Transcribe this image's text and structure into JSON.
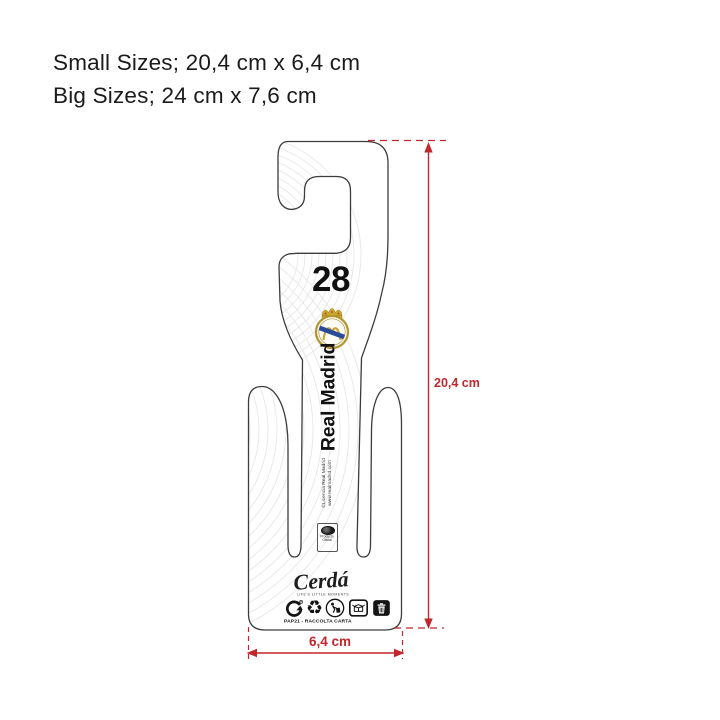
{
  "header": {
    "line1": "Small Sizes; 20,4 cm x 6,4 cm",
    "line2": "Big Sizes; 24 cm x 7,6 cm"
  },
  "hanger": {
    "player_number": "28",
    "team_name": "Real Madrid",
    "license_line1": "©Licencia Real Madrid",
    "license_line2": "www.realmadrid.com",
    "stamp": {
      "line1": "Producto",
      "line2": "Oficial"
    },
    "brand_name": "Cerdá",
    "brand_tagline": "LIFE'S LITTLE MOMENTS",
    "recycling_code": "PAP21 - RACCOLTA CARTA",
    "icons": [
      {
        "name": "recyclable-arrows-icon"
      },
      {
        "name": "mobius-loop-icon"
      },
      {
        "name": "tidyman-icon"
      },
      {
        "name": "paper-packaging-icon"
      },
      {
        "name": "waste-bin-icon"
      }
    ]
  },
  "dimensions": {
    "height_label": "20,4 cm",
    "width_label": "6,4 cm"
  },
  "colors": {
    "dimension_red": "#c1272d",
    "card_outline": "#3d3d3d",
    "text_black": "#111111",
    "crest_gold": "#b5952f",
    "crest_blue": "#2a4a9e",
    "crest_red": "#c0392b"
  }
}
